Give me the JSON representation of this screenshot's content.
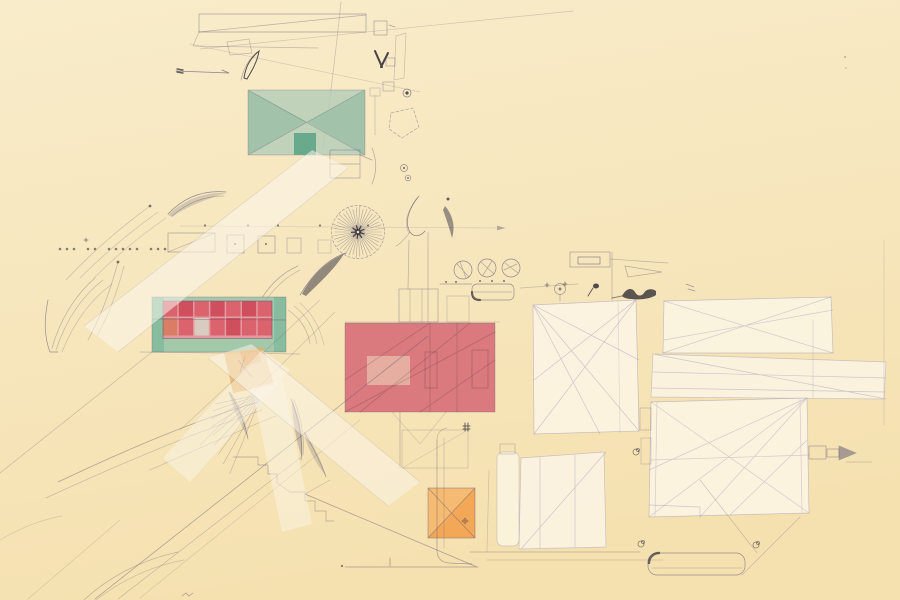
{
  "artwork": {
    "kind": "architectural-site-plan-drawing",
    "media": "pencil linework with translucent colored blocks on cream trace paper",
    "visible_text": ""
  },
  "colors": {
    "paper_top": "#f9ecca",
    "paper_bottom": "#f5e1b0",
    "pencil": "#5b5570",
    "construction": "#8a84ad",
    "ink": "#27242f",
    "strip": "#fbf6ec",
    "sheet": "#fbf4e2",
    "green_roof": "#b5cdb9",
    "green_roof_dark": "#9cc0a6",
    "green_square": "#63a888",
    "teal_base": "#8fc2a6",
    "brick_red": "#d9606c",
    "brick_dark": "#cf4b5b",
    "brick_rust": "#d97b62",
    "brick_pale": "#d7cec1",
    "brick_gap": "#e59aa0",
    "red_block": "#d76e78",
    "red_inset": "#e7b4a4",
    "orange_patch": "#e8ae60",
    "orange_square": "#f1a452",
    "orange_square_light": "#f6bd75"
  },
  "drawing": {
    "sunburst": {
      "cx": 358,
      "cy": 232,
      "radius": 26,
      "ray_count": 42,
      "core_ray_count": 9,
      "core_radius": 7
    },
    "brick_grid": {
      "x": 163,
      "y": 301,
      "width": 109,
      "row_heights": [
        17,
        19
      ],
      "gap": 1.5,
      "cells": [
        [
          "red",
          "dark",
          "red",
          "dark",
          "red",
          "dark",
          "red"
        ],
        [
          "rust",
          "red",
          "pale",
          "red",
          "dark",
          "red",
          "red"
        ]
      ]
    },
    "radial_fan": {
      "cx": 262,
      "cy": 394,
      "start_deg": 112,
      "end_deg": 168,
      "count": 9,
      "inner": 6,
      "lengths": [
        86,
        80,
        74,
        70,
        64,
        60,
        56,
        52,
        48
      ]
    },
    "dot_rows": [
      {
        "y": 249,
        "xs": [
          60,
          67,
          74,
          88,
          95,
          109,
          116,
          123,
          130,
          137,
          151,
          158,
          165
        ],
        "size": 1.3
      },
      {
        "y": 225.5,
        "xs": [
          205,
          248,
          278,
          320,
          368
        ],
        "size": 1.1
      }
    ]
  }
}
